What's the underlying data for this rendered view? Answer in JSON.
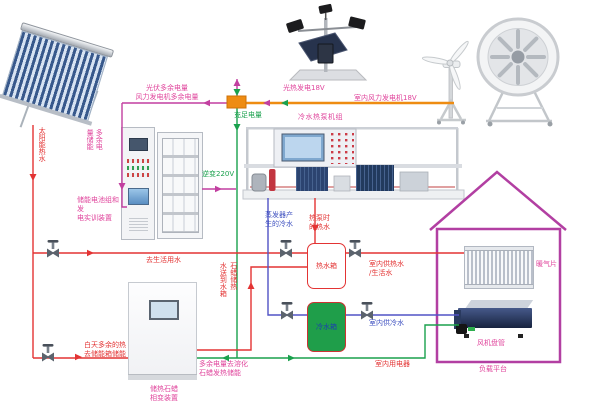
{
  "diagram": {
    "title": "太阳能·风能·热泵综合能源系统示意图",
    "power": {
      "excess_label": "光伏多余电量\n风力发电机多余电量",
      "sufficient_label": "充足电量",
      "pv_label": "光热发电18V",
      "wind_label": "室内风力发电机18V",
      "excess_store_label": "多余电量储能",
      "battery_label": "储能电池组和发\n电实训装置",
      "inverter_label": "逆变220V",
      "indoor_elec_label": "室内用电器",
      "melt_label": "多余电量去溶化\n石蜡发热储能"
    },
    "water": {
      "solar_hot_label": "太阳能热水",
      "domestic_label": "去生活用水",
      "evap_cold_label": "蒸发器产\n生的冷水",
      "hp_hot_label": "热泵时\n的热水",
      "hot_tank_label": "热水箱",
      "cold_tank_label": "冷水箱",
      "indoor_hot_label": "室内供热水\n/生活水",
      "indoor_cold_label": "室内供冷水",
      "paraffin_send_col_left": "水送到水箱",
      "paraffin_send_col_right": "石蜡储热",
      "daytime_label": "白天多余的热\n去储能箱储能"
    },
    "units": {
      "heat_pump_label": "冷水热泵机组",
      "paraffin_label": "储热石蜡\n相变装置",
      "radiator_label": "暖气片",
      "fan_coil_label": "风机盘管",
      "platform_label": "负载平台"
    },
    "colors": {
      "power_excess": "#c23fa0",
      "power_bus": "#ee8c12",
      "power_ok": "#1aa14d",
      "hot_water": "#e33434",
      "cold_water": "#5153c5",
      "house_outline": "#b23fa2"
    }
  }
}
